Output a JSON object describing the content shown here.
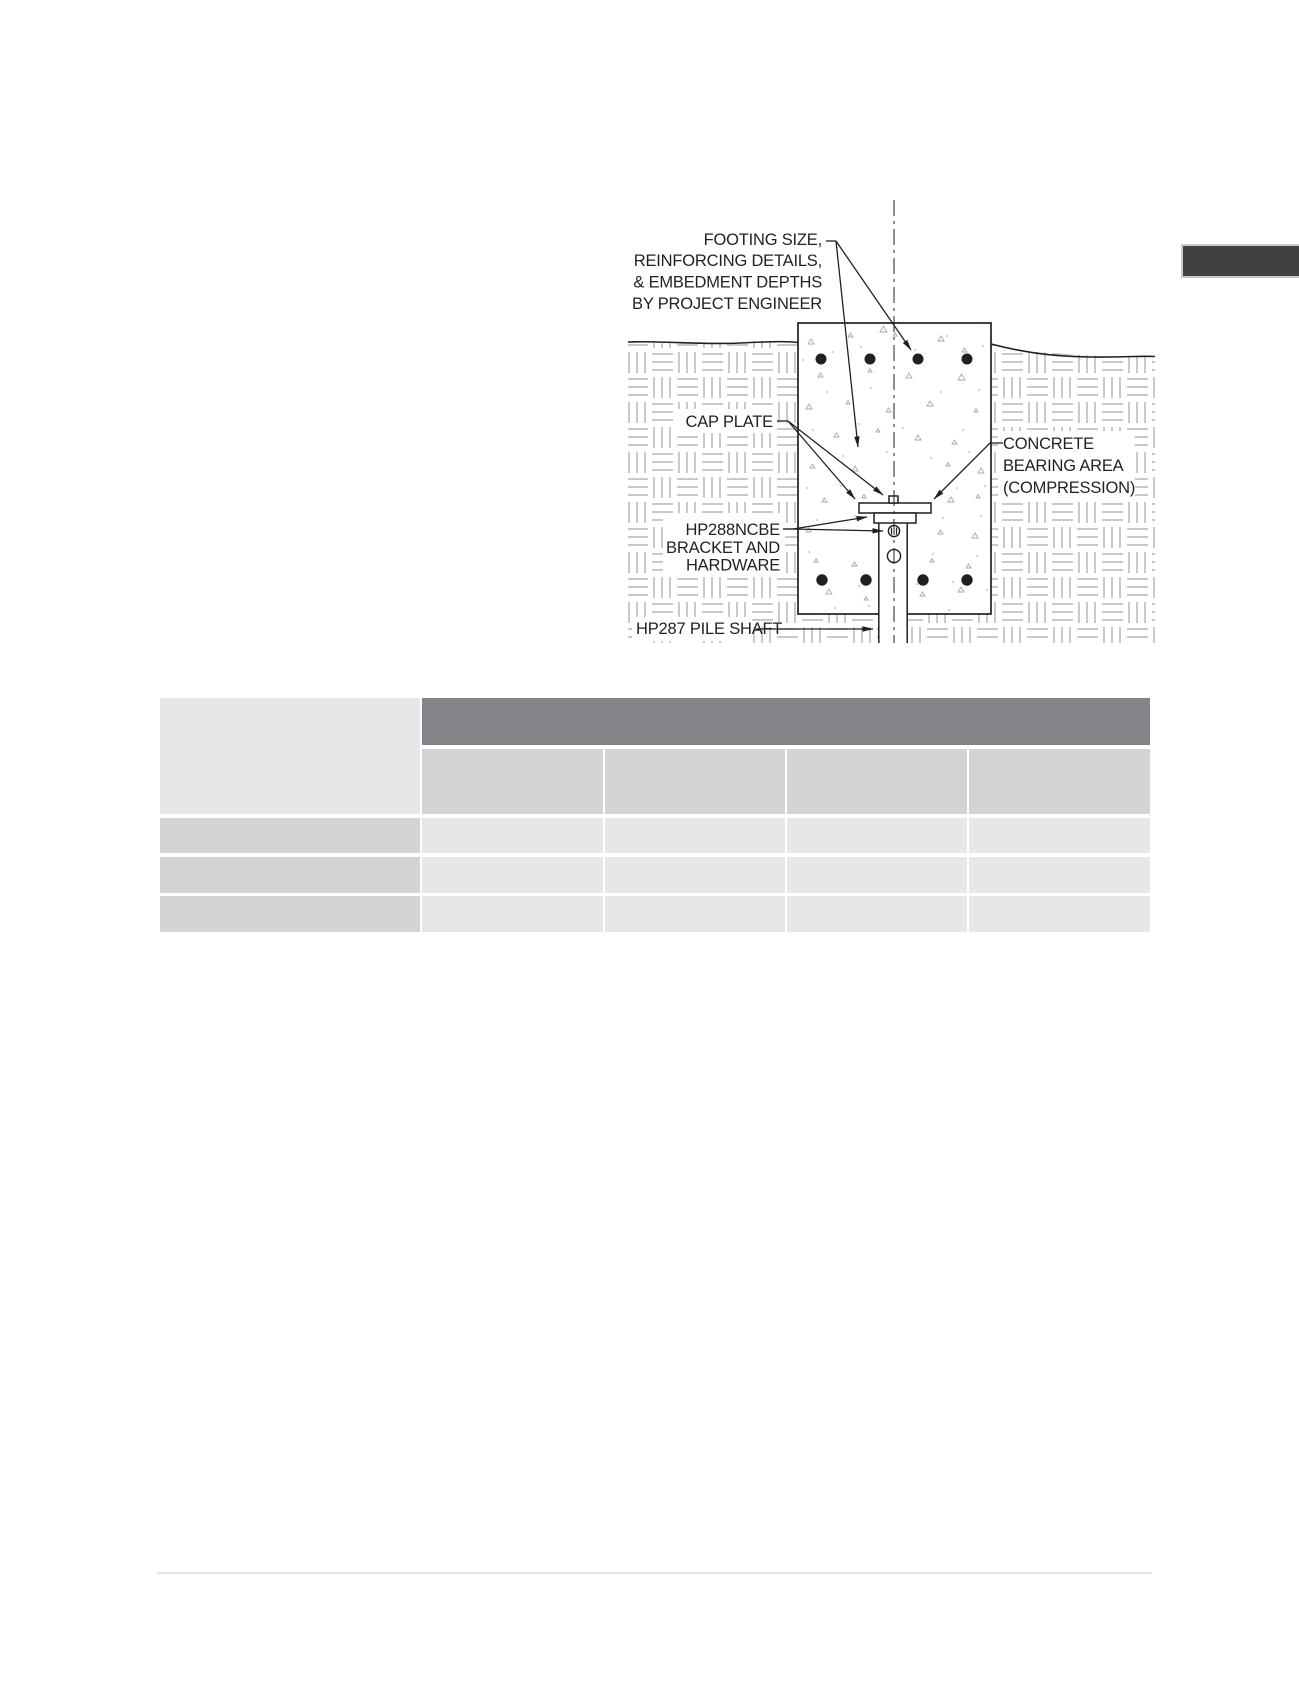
{
  "diagram": {
    "labels": {
      "footing_note": {
        "lines": [
          "FOOTING SIZE,",
          "REINFORCING DETAILS,",
          "& EMBEDMENT DEPTHS",
          "BY PROJECT ENGINEER"
        ]
      },
      "cap_plate": {
        "text": "CAP PLATE"
      },
      "concrete_bearing": {
        "lines": [
          "CONCRETE",
          "BEARING AREA",
          "(COMPRESSION)"
        ]
      },
      "bracket": {
        "lines": [
          "HP288NCBE",
          "BRACKET AND",
          "HARDWARE"
        ]
      },
      "pile_shaft": {
        "text": "HP287 PILE SHAFT"
      }
    },
    "colors": {
      "line": "#231f20",
      "hatch": "#b5b7b9",
      "speckle": "#a7a9ac"
    }
  },
  "side_tab": {
    "color": "#414042"
  },
  "table": {
    "structure": {
      "data_columns": 4,
      "data_rows": 3
    },
    "header_band_label": "",
    "subheader_labels": [
      "",
      "",
      "",
      ""
    ],
    "row_labels": [
      "",
      "",
      ""
    ],
    "cells": [
      [
        "",
        "",
        "",
        ""
      ],
      [
        "",
        "",
        "",
        ""
      ],
      [
        "",
        "",
        "",
        ""
      ]
    ],
    "colors": {
      "band": "#828487",
      "subheader": "#d2d4d5",
      "row_label": "#d2d4d5",
      "data_cell": "#e6e7e9"
    }
  },
  "footer": {
    "rule_color": "#e2e3e4"
  }
}
